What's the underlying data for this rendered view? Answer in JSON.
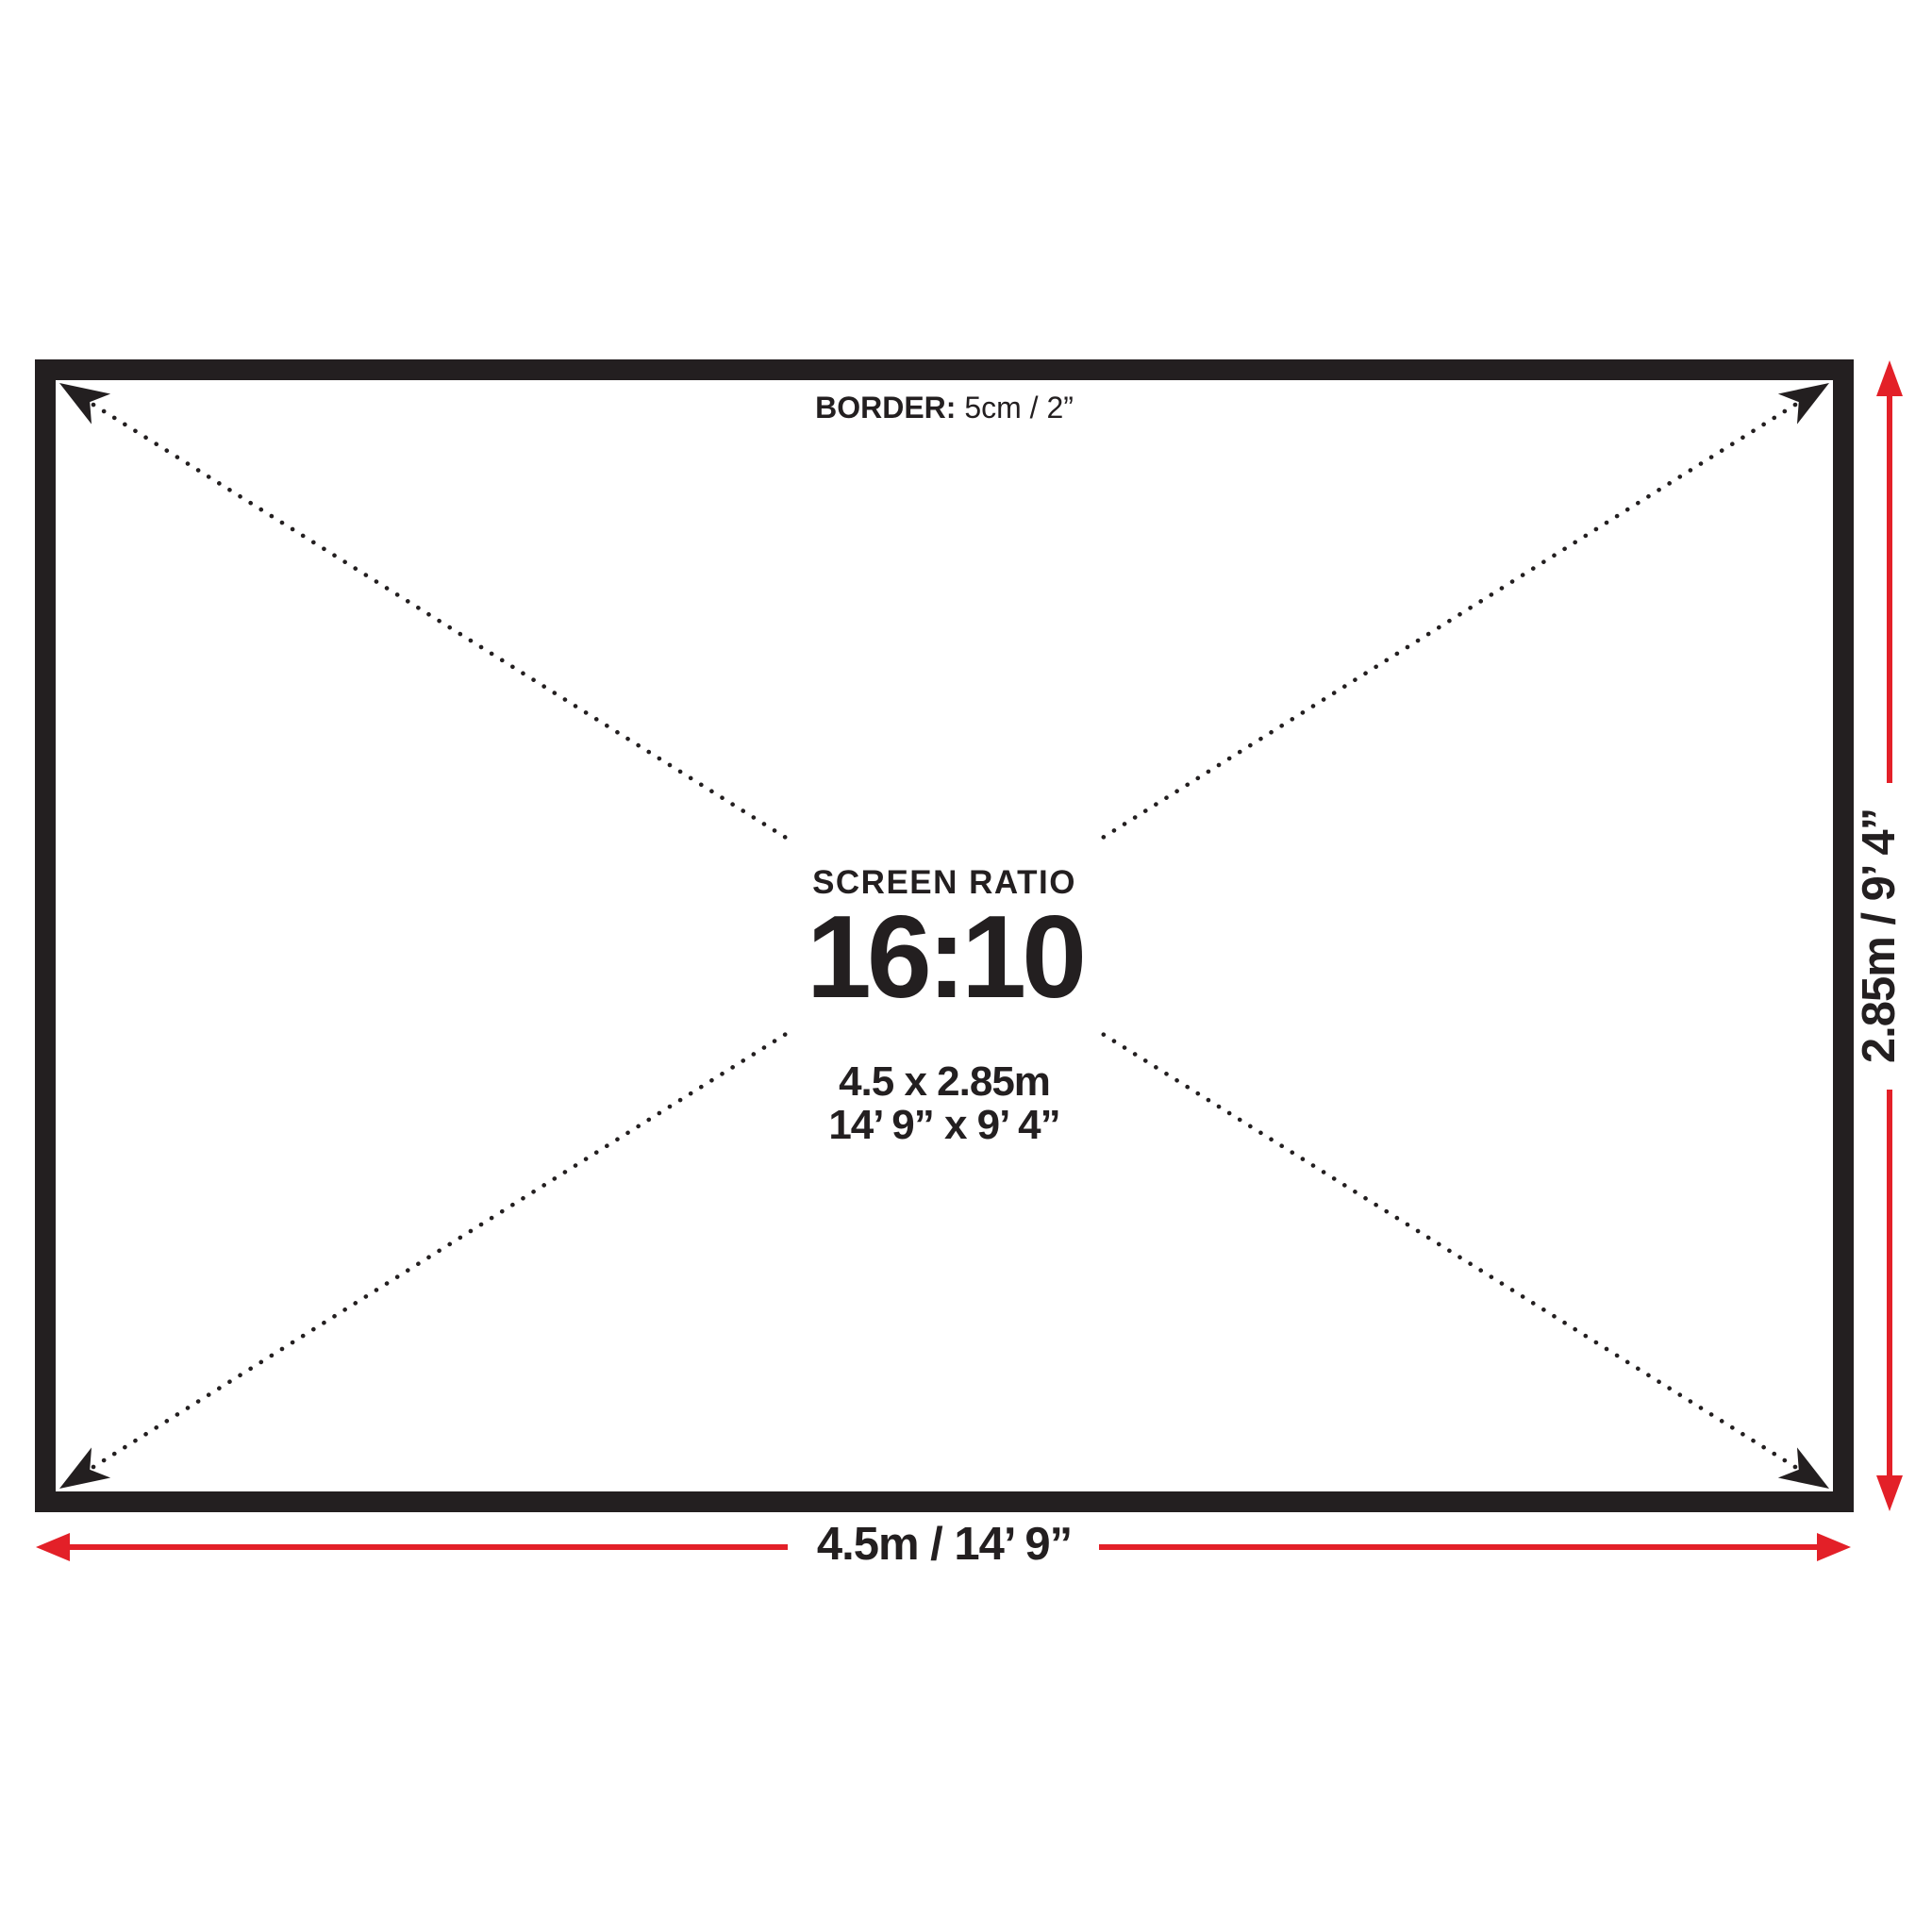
{
  "diagram": {
    "border_note": {
      "label": "BORDER:",
      "value": " 5cm / 2”"
    },
    "center": {
      "title": "SCREEN RATIO",
      "ratio": "16:10",
      "size_metric": "4.5 x 2.85m",
      "size_imperial": "14’ 9” x 9’ 4”"
    },
    "dimensions": {
      "width_label": "4.5m / 14’ 9”",
      "height_label": "2.85m / 9’ 4”"
    },
    "colors": {
      "ink": "#231f20",
      "red": "#e32028"
    }
  }
}
